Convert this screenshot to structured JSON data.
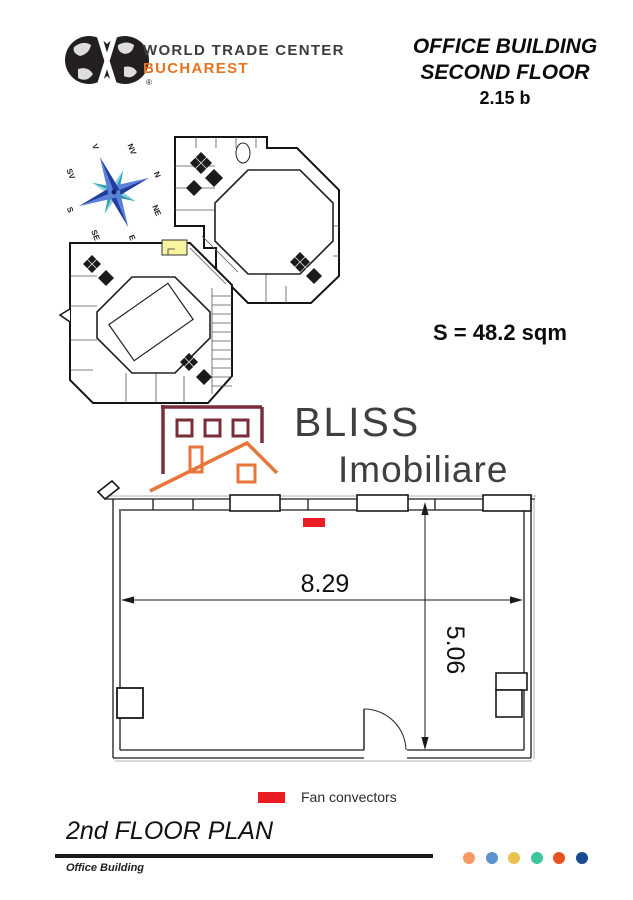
{
  "header": {
    "logo_line1": "WORLD TRADE CENTER",
    "logo_line2": "BUCHAREST",
    "logo_reg": "®",
    "title_line1": "OFFICE BUILDING",
    "title_line2": "SECOND FLOOR",
    "title_line3": "2.15 b"
  },
  "compass": {
    "labels": {
      "n": "N",
      "ne": "NE",
      "e": "E",
      "se": "SE",
      "s": "S",
      "sv": "SV",
      "v": "V",
      "nv": "NV"
    }
  },
  "overview": {
    "highlight_color": "#f7f3a0"
  },
  "area_label": "S = 48.2 sqm",
  "watermark": {
    "name_line1": "BLISS",
    "name_line2": "Imobiliare",
    "house_color": "#7b2d3a",
    "roof_color": "#e8763a"
  },
  "room_plan": {
    "width_m": "8.29",
    "depth_m": "5.06",
    "fan_color": "#ec1c24"
  },
  "legend": {
    "fan_label": "Fan convectors",
    "fan_color": "#ec1c24"
  },
  "footer": {
    "plan_title": "2nd FLOOR PLAN",
    "building_label": "Office Building",
    "dots": [
      "#f59b62",
      "#5c92cf",
      "#e9c14d",
      "#3ec69e",
      "#e5531f",
      "#1a4a8f"
    ]
  }
}
